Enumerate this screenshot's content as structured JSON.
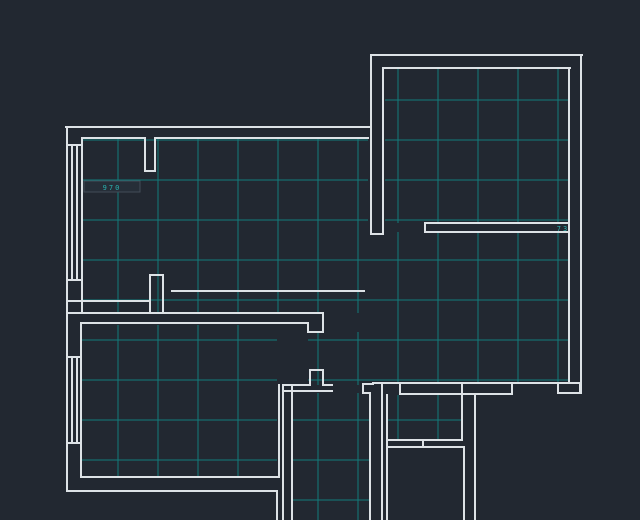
{
  "app": {
    "view_name": "cad-floorplan-view"
  },
  "floorplan": {
    "canvas": {
      "width": 640,
      "height": 520
    },
    "colors": {
      "background": "#222831",
      "wall": "#dde2e6",
      "grid": "#127c7c",
      "annotation": "#2ab3b0",
      "annotation_box_fill": "#262e38",
      "annotation_box_stroke": "#434c57"
    },
    "grid": {
      "x0": 78,
      "y0": 100,
      "step": 40
    },
    "grid_regions": [
      {
        "x1": 82,
        "y1": 139,
        "x2": 368,
        "y2": 313
      },
      {
        "x1": 368,
        "y1": 238,
        "x2": 383,
        "y2": 383
      },
      {
        "x1": 308,
        "y1": 332,
        "x2": 368,
        "y2": 385
      },
      {
        "x1": 383,
        "y1": 232,
        "x2": 569,
        "y2": 383
      },
      {
        "x1": 81,
        "y1": 325,
        "x2": 277,
        "y2": 477
      },
      {
        "x1": 292,
        "y1": 393,
        "x2": 370,
        "y2": 520
      },
      {
        "x1": 385,
        "y1": 68,
        "x2": 568,
        "y2": 223
      },
      {
        "x1": 387,
        "y1": 395,
        "x2": 462,
        "y2": 440
      }
    ],
    "walls": [
      [
        371,
        55,
        582,
        55
      ],
      [
        371,
        55,
        371,
        234
      ],
      [
        383,
        68,
        383,
        234
      ],
      [
        371,
        234,
        383,
        234
      ],
      [
        383,
        68,
        570,
        68
      ],
      [
        581,
        55,
        581,
        393
      ],
      [
        569,
        68,
        569,
        383
      ],
      [
        425,
        223,
        569,
        223
      ],
      [
        425,
        232,
        569,
        232
      ],
      [
        425,
        223,
        425,
        232
      ],
      [
        66,
        127,
        371,
        127
      ],
      [
        82,
        138,
        145,
        138
      ],
      [
        145,
        138,
        145,
        171
      ],
      [
        145,
        171,
        155,
        171
      ],
      [
        155,
        171,
        155,
        138
      ],
      [
        155,
        138,
        368,
        138
      ],
      [
        67,
        127,
        67,
        491
      ],
      [
        82,
        138,
        82,
        313
      ],
      [
        72,
        145,
        72,
        280
      ],
      [
        77,
        145,
        77,
        280
      ],
      [
        67,
        145,
        82,
        145
      ],
      [
        67,
        280,
        82,
        280
      ],
      [
        67,
        301,
        150,
        301
      ],
      [
        150,
        275,
        150,
        313
      ],
      [
        150,
        275,
        163,
        275
      ],
      [
        163,
        275,
        163,
        313
      ],
      [
        172,
        291,
        364,
        291
      ],
      [
        67,
        313,
        323,
        313
      ],
      [
        81,
        323,
        308,
        323
      ],
      [
        308,
        323,
        308,
        332
      ],
      [
        308,
        332,
        323,
        332
      ],
      [
        323,
        332,
        323,
        313
      ],
      [
        81,
        323,
        81,
        477
      ],
      [
        72,
        357,
        72,
        443
      ],
      [
        77,
        357,
        77,
        443
      ],
      [
        67,
        357,
        81,
        357
      ],
      [
        67,
        443,
        81,
        443
      ],
      [
        81,
        477,
        278,
        477
      ],
      [
        67,
        491,
        277,
        491
      ],
      [
        279,
        385,
        279,
        477
      ],
      [
        277,
        491,
        277,
        520
      ],
      [
        283,
        385,
        283,
        520
      ],
      [
        292,
        385,
        292,
        520
      ],
      [
        283,
        385,
        310,
        385
      ],
      [
        310,
        385,
        310,
        370
      ],
      [
        310,
        370,
        323,
        370
      ],
      [
        323,
        370,
        323,
        385
      ],
      [
        323,
        385,
        332,
        385
      ],
      [
        283,
        391,
        332,
        391
      ],
      [
        363,
        384,
        373,
        384
      ],
      [
        363,
        384,
        363,
        393
      ],
      [
        363,
        393,
        370,
        393
      ],
      [
        370,
        393,
        370,
        520
      ],
      [
        382,
        384,
        382,
        520
      ],
      [
        387,
        395,
        387,
        520
      ],
      [
        373,
        383,
        581,
        383
      ],
      [
        400,
        383,
        400,
        394
      ],
      [
        400,
        394,
        512,
        394
      ],
      [
        512,
        394,
        512,
        383
      ],
      [
        558,
        383,
        558,
        393
      ],
      [
        558,
        393,
        580,
        393
      ],
      [
        580,
        393,
        580,
        383
      ],
      [
        462,
        384,
        462,
        440
      ],
      [
        475,
        394,
        475,
        520
      ],
      [
        464,
        447,
        464,
        520
      ],
      [
        387,
        440,
        462,
        440
      ],
      [
        387,
        447,
        464,
        447
      ],
      [
        423,
        440,
        423,
        447
      ]
    ],
    "annotations": [
      {
        "text": "970",
        "x": 112,
        "y": 190,
        "boxed": true,
        "box": [
          84,
          181,
          56,
          11
        ]
      },
      {
        "text": "73",
        "x": 563,
        "y": 231,
        "boxed": false
      }
    ]
  }
}
